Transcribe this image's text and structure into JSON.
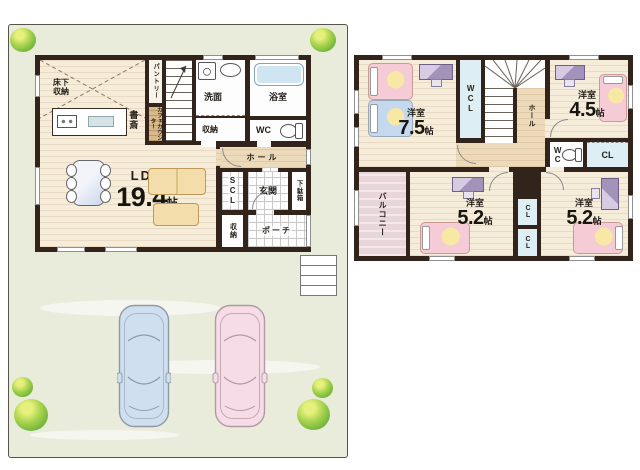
{
  "floor1": {
    "underfloor_storage": "床下収納",
    "study": "書斎",
    "pantry": "パントリー",
    "cafe_counter": "カフェカウンター",
    "washroom": "洗面",
    "washroom_storage": "収納",
    "bathroom": "浴室",
    "wc": "WC",
    "hall": "ホール",
    "ldk": {
      "label": "LDK",
      "size": "19.4",
      "unit": "帖"
    },
    "scl": "SCL",
    "entrance": "玄関",
    "shoe_cabinet": "下駄箱",
    "storage": "収納",
    "porch": "ポーチ"
  },
  "floor2": {
    "room_a": {
      "label": "洋室",
      "size": "7.5",
      "unit": "帖"
    },
    "room_b": {
      "label": "洋室",
      "size": "4.5",
      "unit": "帖"
    },
    "room_c": {
      "label": "洋室",
      "size": "5.2",
      "unit": "帖"
    },
    "room_d": {
      "label": "洋室",
      "size": "5.2",
      "unit": "帖"
    },
    "wcl": "WCL",
    "hall": "ホール",
    "wc": "WC",
    "closet_east": "CL",
    "closet_mid_upper": "CL",
    "closet_mid_lower": "CL",
    "balcony": "バルコニー"
  },
  "colors": {
    "wall": "#32241b",
    "wood_floor": "#f5ecd9",
    "hall_floor": "#ecdabb",
    "closet_blue": "#ddeef5",
    "balcony_pink": "#e8d6da",
    "lot_green": "#e9ecdb",
    "bush_green": "#73b53c",
    "car_blue": "#cfdff0",
    "car_pink": "#f5dce6",
    "bed_pink": "#f5cbd5",
    "bed_blue": "#c5d9ee",
    "sofa_tan": "#f3deab",
    "counter_wood": "#d9b98a"
  }
}
